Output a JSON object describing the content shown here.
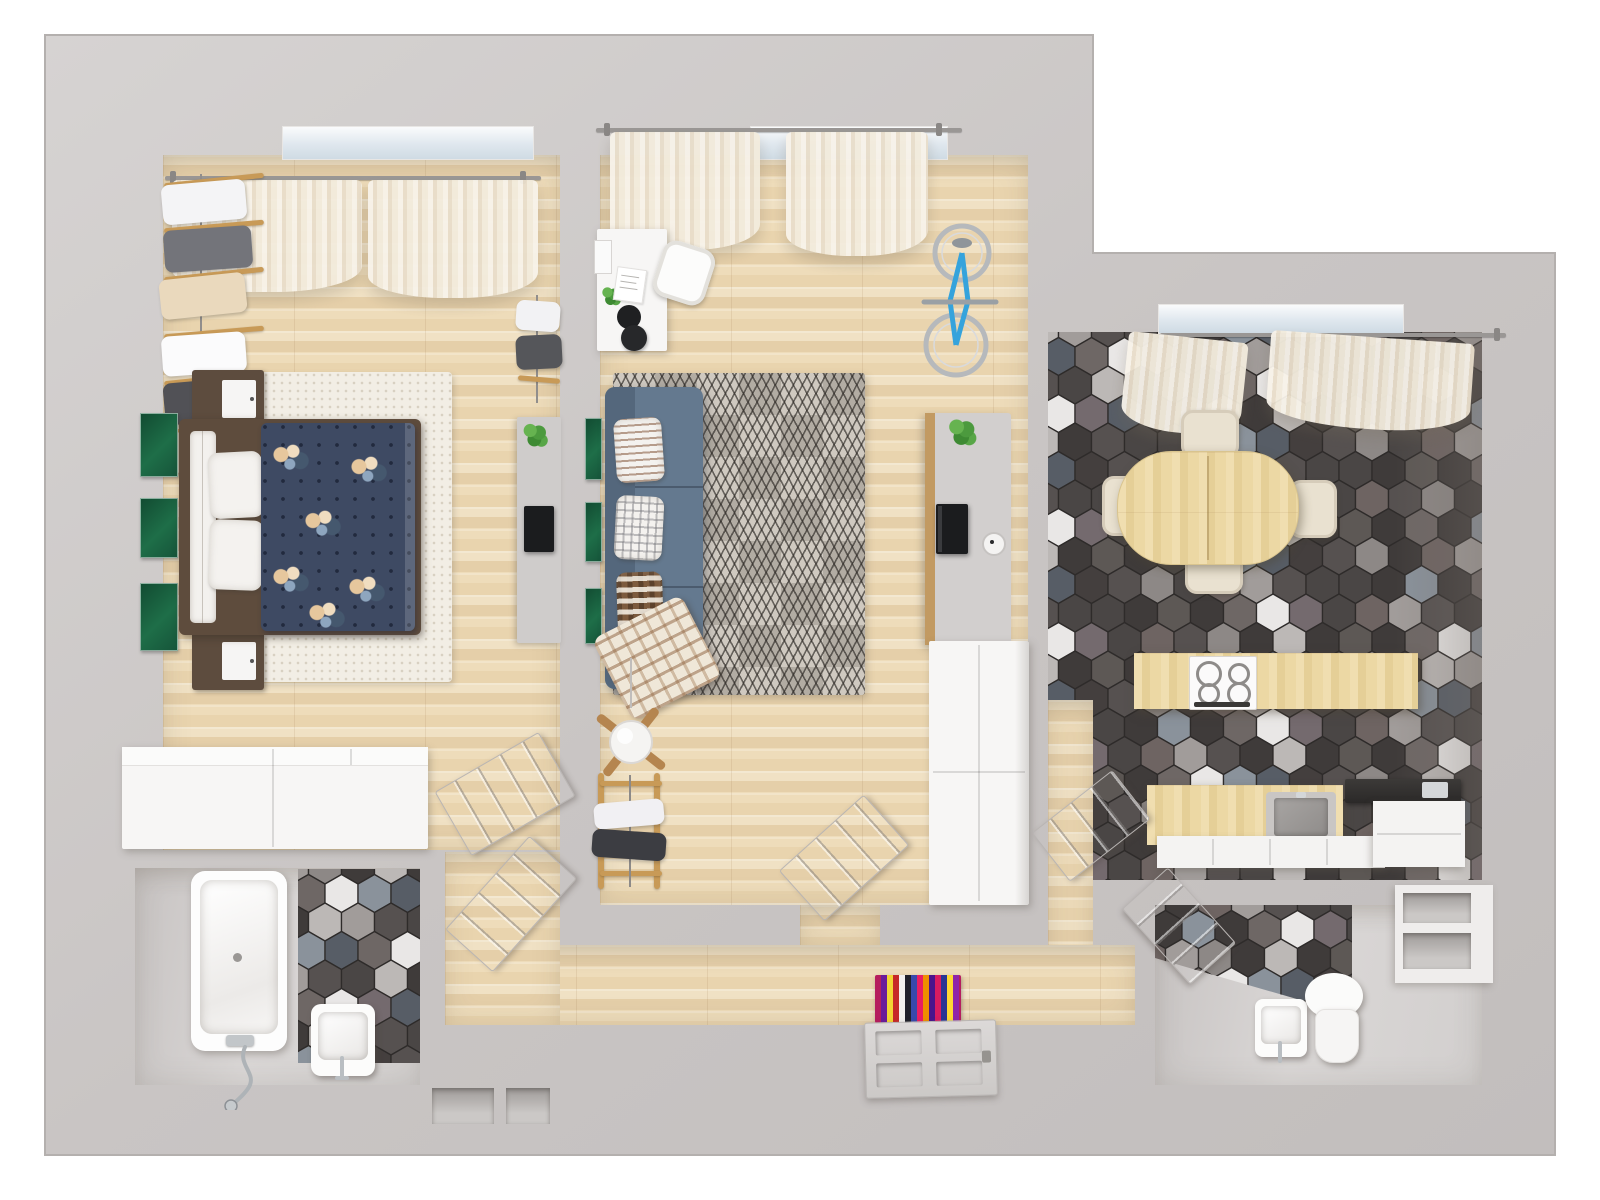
{
  "meta": {
    "type": "3d-apartment-floorplan-top-view",
    "canvas": {
      "width": 1600,
      "height": 1200
    }
  },
  "palette": {
    "bg": "#ffffff",
    "wall": "#c9c5c4",
    "wall_light": "#dbd8d7",
    "wall_edge": "#b4b0ae",
    "wood_floor": "#ecdabb",
    "kitchen_wood": "#ecd8a8",
    "gray_floor": "#d5d2d1",
    "counter_white": "#f4f3f2",
    "counter_dark": "#323030",
    "sofa": "#64798f",
    "sofa_back": "#54677c",
    "duvet_navy": "#3e4a63",
    "bed_wood": "#5e4c3d",
    "rug_bedroom": "#f2eee5",
    "rug_living": "#c3bdb4",
    "curtain": "#f2ebdd",
    "door": "#d7d4d2",
    "chrome": "#b3b8bc",
    "green_art": "#1e6e48",
    "plant_green": "#4c9a3e",
    "bike_blue": "#35a3dc",
    "tv_black": "#1b1c1e",
    "table_wood": "#ecd8a4",
    "chair_cream": "#e9e1d0",
    "hex_tiles": [
      "#3f3b3a",
      "#443f3e",
      "#3f3b3a",
      "#565150",
      "#4a4645",
      "#6e6765",
      "#3f3b3a",
      "#8d8886",
      "#575d66",
      "#4a4645",
      "#a19c9a",
      "#746a6e",
      "#3f3b3a",
      "#bcb8b6",
      "#565150",
      "#8a929b",
      "#4a4645",
      "#6e6462",
      "#e9e7e6",
      "#5d5855"
    ],
    "hall_rug_stripes": [
      "#b51d5e",
      "#6a1b9a",
      "#f3d335",
      "#c62828",
      "#f2f0ee",
      "#20202a",
      "#3949ab",
      "#e91e63",
      "#ef8f00",
      "#4a148c",
      "#d81b60",
      "#283593",
      "#fdd835",
      "#8e24aa"
    ]
  },
  "rooms": {
    "bedroom": {
      "label": "bedroom",
      "items": [
        "double-bed",
        "navy-floral-duvet",
        "white-rug",
        "two-nightstands",
        "white-wardrobe",
        "clothes-rack",
        "dresser-with-tv",
        "green-wall-art",
        "sheer-curtains"
      ]
    },
    "living_room": {
      "label": "living-room",
      "items": [
        "blue-sofa",
        "geometric-rug",
        "white-desk",
        "desk-chair",
        "wall-mounted-bike",
        "media-console",
        "tv",
        "tall-white-cabinet",
        "ceiling-fan",
        "drying-rack",
        "green-wall-art",
        "sheer-curtains"
      ]
    },
    "kitchen_dining": {
      "label": "kitchen-dining-room",
      "items": [
        "hex-tile-floor",
        "oval-dining-table",
        "four-cream-chairs",
        "cooktop-counter",
        "sink-counter",
        "white-cabinets",
        "sheer-curtains"
      ]
    },
    "bathroom": {
      "label": "bathroom",
      "items": [
        "bathtub",
        "shower-hose",
        "wash-basin",
        "hex-tile-wall"
      ]
    },
    "wc": {
      "label": "toilet-room",
      "items": [
        "toilet",
        "wash-basin",
        "wall-shelf-niches",
        "hex-tile-wall"
      ]
    },
    "hallway": {
      "label": "hallway",
      "items": [
        "entry-door",
        "striped-rug",
        "interior-doors",
        "wall-niches"
      ]
    }
  }
}
